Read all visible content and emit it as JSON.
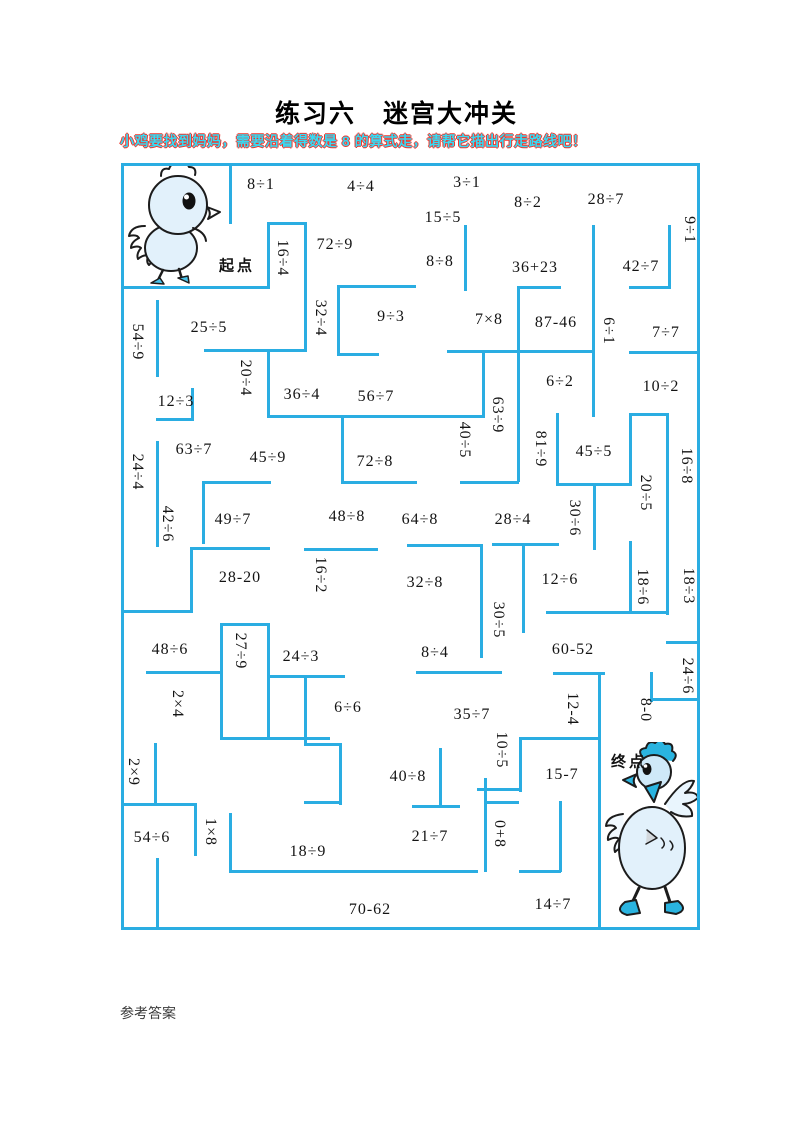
{
  "title": "练习六　迷宫大冲关",
  "instruction": "小鸡要找到妈妈，需要沿着得数是 8 的算式走，请帮它描出行走路线吧！",
  "footer": "参考答案",
  "colors": {
    "wall": "#2aade2",
    "instruction_fill": "#38d9f2",
    "instruction_edge": "#f0342a",
    "bird_accent": "#2ab4e0",
    "bird_body": "#e2f1fb"
  },
  "maze": {
    "start_label": {
      "text": "起点",
      "x": 237,
      "y": 265
    },
    "end_label": {
      "text": "终点",
      "x": 629,
      "y": 761
    },
    "target_number": "8",
    "items": [
      {
        "t": "8÷1",
        "x": 261,
        "y": 185,
        "r": 0
      },
      {
        "t": "4÷4",
        "x": 361,
        "y": 187,
        "r": 0
      },
      {
        "t": "3÷1",
        "x": 467,
        "y": 183,
        "r": 0
      },
      {
        "t": "15÷5",
        "x": 443,
        "y": 218,
        "r": 0
      },
      {
        "t": "8÷2",
        "x": 528,
        "y": 203,
        "r": 0
      },
      {
        "t": "28÷7",
        "x": 606,
        "y": 200,
        "r": 0
      },
      {
        "t": "9÷1",
        "x": 689,
        "y": 230,
        "r": 1
      },
      {
        "t": "16÷4",
        "x": 282,
        "y": 258,
        "r": 1
      },
      {
        "t": "72÷9",
        "x": 335,
        "y": 245,
        "r": 0
      },
      {
        "t": "8÷8",
        "x": 440,
        "y": 262,
        "r": 0
      },
      {
        "t": "36+23",
        "x": 535,
        "y": 268,
        "r": 0
      },
      {
        "t": "42÷7",
        "x": 641,
        "y": 267,
        "r": 0
      },
      {
        "t": "32÷4",
        "x": 320,
        "y": 318,
        "r": 1
      },
      {
        "t": "9÷3",
        "x": 391,
        "y": 317,
        "r": 0
      },
      {
        "t": "7×8",
        "x": 489,
        "y": 320,
        "r": 0
      },
      {
        "t": "87-46",
        "x": 556,
        "y": 323,
        "r": 0
      },
      {
        "t": "6÷1",
        "x": 608,
        "y": 331,
        "r": 1
      },
      {
        "t": "7÷7",
        "x": 666,
        "y": 333,
        "r": 0
      },
      {
        "t": "54÷9",
        "x": 137,
        "y": 342,
        "r": 1
      },
      {
        "t": "25÷5",
        "x": 209,
        "y": 328,
        "r": 0
      },
      {
        "t": "20÷4",
        "x": 245,
        "y": 378,
        "r": 1
      },
      {
        "t": "36÷4",
        "x": 302,
        "y": 395,
        "r": 0
      },
      {
        "t": "56÷7",
        "x": 376,
        "y": 397,
        "r": 0
      },
      {
        "t": "12÷3",
        "x": 176,
        "y": 402,
        "r": 0
      },
      {
        "t": "63÷9",
        "x": 497,
        "y": 415,
        "r": 1
      },
      {
        "t": "40÷5",
        "x": 464,
        "y": 440,
        "r": 1
      },
      {
        "t": "81÷9",
        "x": 540,
        "y": 449,
        "r": 1
      },
      {
        "t": "45÷5",
        "x": 594,
        "y": 452,
        "r": 0
      },
      {
        "t": "6÷2",
        "x": 560,
        "y": 382,
        "r": 0
      },
      {
        "t": "10÷2",
        "x": 661,
        "y": 387,
        "r": 0
      },
      {
        "t": "16÷8",
        "x": 686,
        "y": 466,
        "r": 1
      },
      {
        "t": "24÷4",
        "x": 137,
        "y": 472,
        "r": 1
      },
      {
        "t": "63÷7",
        "x": 194,
        "y": 450,
        "r": 0
      },
      {
        "t": "45÷9",
        "x": 268,
        "y": 458,
        "r": 0
      },
      {
        "t": "72÷8",
        "x": 375,
        "y": 462,
        "r": 0
      },
      {
        "t": "20÷5",
        "x": 645,
        "y": 493,
        "r": 1
      },
      {
        "t": "42÷6",
        "x": 167,
        "y": 524,
        "r": 1
      },
      {
        "t": "49÷7",
        "x": 233,
        "y": 520,
        "r": 0
      },
      {
        "t": "48÷8",
        "x": 347,
        "y": 517,
        "r": 0
      },
      {
        "t": "64÷8",
        "x": 420,
        "y": 520,
        "r": 0
      },
      {
        "t": "28÷4",
        "x": 513,
        "y": 520,
        "r": 0
      },
      {
        "t": "30÷6",
        "x": 574,
        "y": 518,
        "r": 1
      },
      {
        "t": "28-20",
        "x": 240,
        "y": 578,
        "r": 0
      },
      {
        "t": "16÷2",
        "x": 320,
        "y": 575,
        "r": 1
      },
      {
        "t": "32÷8",
        "x": 425,
        "y": 583,
        "r": 0
      },
      {
        "t": "12÷6",
        "x": 560,
        "y": 580,
        "r": 0
      },
      {
        "t": "18÷6",
        "x": 642,
        "y": 587,
        "r": 1
      },
      {
        "t": "18÷3",
        "x": 688,
        "y": 586,
        "r": 1
      },
      {
        "t": "48÷6",
        "x": 170,
        "y": 650,
        "r": 0
      },
      {
        "t": "27÷9",
        "x": 240,
        "y": 651,
        "r": 1
      },
      {
        "t": "24÷3",
        "x": 301,
        "y": 657,
        "r": 0
      },
      {
        "t": "30÷5",
        "x": 498,
        "y": 620,
        "r": 1
      },
      {
        "t": "8÷4",
        "x": 435,
        "y": 653,
        "r": 0
      },
      {
        "t": "60-52",
        "x": 573,
        "y": 650,
        "r": 0
      },
      {
        "t": "24÷6",
        "x": 687,
        "y": 676,
        "r": 1
      },
      {
        "t": "2×4",
        "x": 177,
        "y": 704,
        "r": 1
      },
      {
        "t": "6÷6",
        "x": 348,
        "y": 708,
        "r": 0
      },
      {
        "t": "35÷7",
        "x": 472,
        "y": 715,
        "r": 0
      },
      {
        "t": "12-4",
        "x": 572,
        "y": 709,
        "r": 1
      },
      {
        "t": "8-0",
        "x": 645,
        "y": 710,
        "r": 1
      },
      {
        "t": "2×9",
        "x": 133,
        "y": 772,
        "r": 1
      },
      {
        "t": "10÷5",
        "x": 501,
        "y": 750,
        "r": 1
      },
      {
        "t": "15-7",
        "x": 562,
        "y": 775,
        "r": 0
      },
      {
        "t": "40÷8",
        "x": 408,
        "y": 777,
        "r": 0
      },
      {
        "t": "54÷6",
        "x": 152,
        "y": 838,
        "r": 0
      },
      {
        "t": "1×8",
        "x": 210,
        "y": 832,
        "r": 1
      },
      {
        "t": "18÷9",
        "x": 308,
        "y": 852,
        "r": 0
      },
      {
        "t": "21÷7",
        "x": 430,
        "y": 837,
        "r": 0
      },
      {
        "t": "0+8",
        "x": 499,
        "y": 834,
        "r": 1
      },
      {
        "t": "70-62",
        "x": 370,
        "y": 910,
        "r": 0
      },
      {
        "t": "14÷7",
        "x": 553,
        "y": 905,
        "r": 0
      }
    ],
    "walls": [
      [
        121,
        163,
        579,
        3
      ],
      [
        121,
        927,
        579,
        3
      ],
      [
        121,
        163,
        3,
        767
      ],
      [
        697,
        163,
        3,
        767
      ],
      [
        229,
        163,
        3,
        61
      ],
      [
        267,
        222,
        40,
        3
      ],
      [
        267,
        222,
        3,
        66
      ],
      [
        121,
        286,
        149,
        3
      ],
      [
        304,
        222,
        3,
        130
      ],
      [
        204,
        349,
        103,
        3
      ],
      [
        267,
        349,
        3,
        69
      ],
      [
        267,
        415,
        218,
        3
      ],
      [
        156,
        300,
        3,
        77
      ],
      [
        156,
        418,
        38,
        3
      ],
      [
        191,
        388,
        3,
        33
      ],
      [
        156,
        441,
        3,
        106
      ],
      [
        337,
        285,
        79,
        3
      ],
      [
        337,
        285,
        3,
        71
      ],
      [
        337,
        353,
        42,
        3
      ],
      [
        464,
        225,
        3,
        66
      ],
      [
        517,
        286,
        3,
        196
      ],
      [
        517,
        286,
        44,
        3
      ],
      [
        592,
        225,
        3,
        192
      ],
      [
        447,
        350,
        147,
        3
      ],
      [
        482,
        350,
        3,
        67
      ],
      [
        460,
        481,
        59,
        3
      ],
      [
        668,
        225,
        3,
        64
      ],
      [
        629,
        286,
        41,
        3
      ],
      [
        629,
        351,
        71,
        3
      ],
      [
        629,
        413,
        40,
        3
      ],
      [
        629,
        413,
        3,
        73
      ],
      [
        666,
        413,
        3,
        202
      ],
      [
        556,
        413,
        3,
        73
      ],
      [
        556,
        483,
        76,
        3
      ],
      [
        593,
        485,
        3,
        65
      ],
      [
        546,
        611,
        123,
        3
      ],
      [
        629,
        541,
        3,
        72
      ],
      [
        666,
        641,
        33,
        3
      ],
      [
        492,
        543,
        67,
        3
      ],
      [
        190,
        547,
        80,
        3
      ],
      [
        190,
        547,
        3,
        66
      ],
      [
        121,
        610,
        71,
        3
      ],
      [
        304,
        548,
        74,
        3
      ],
      [
        407,
        544,
        76,
        3
      ],
      [
        202,
        481,
        69,
        3
      ],
      [
        202,
        481,
        3,
        63
      ],
      [
        522,
        543,
        3,
        90
      ],
      [
        480,
        545,
        3,
        113
      ],
      [
        341,
        481,
        76,
        3
      ],
      [
        341,
        416,
        3,
        68
      ],
      [
        220,
        623,
        50,
        3
      ],
      [
        220,
        623,
        3,
        117
      ],
      [
        267,
        623,
        3,
        117
      ],
      [
        146,
        671,
        76,
        3
      ],
      [
        220,
        737,
        110,
        3
      ],
      [
        154,
        743,
        3,
        63
      ],
      [
        121,
        803,
        76,
        3
      ],
      [
        194,
        803,
        3,
        53
      ],
      [
        156,
        858,
        3,
        70
      ],
      [
        229,
        870,
        249,
        3
      ],
      [
        229,
        813,
        3,
        60
      ],
      [
        267,
        675,
        78,
        3
      ],
      [
        304,
        675,
        3,
        70
      ],
      [
        304,
        743,
        38,
        3
      ],
      [
        339,
        743,
        3,
        62
      ],
      [
        304,
        801,
        38,
        3
      ],
      [
        412,
        805,
        48,
        3
      ],
      [
        439,
        748,
        3,
        59
      ],
      [
        416,
        671,
        86,
        3
      ],
      [
        553,
        672,
        52,
        3
      ],
      [
        598,
        672,
        3,
        258
      ],
      [
        519,
        737,
        81,
        3
      ],
      [
        519,
        737,
        3,
        55
      ],
      [
        477,
        788,
        44,
        3
      ],
      [
        484,
        778,
        3,
        94
      ],
      [
        484,
        801,
        35,
        3
      ],
      [
        559,
        801,
        3,
        71
      ],
      [
        519,
        870,
        42,
        3
      ],
      [
        650,
        672,
        3,
        30
      ],
      [
        650,
        698,
        49,
        3
      ]
    ]
  }
}
